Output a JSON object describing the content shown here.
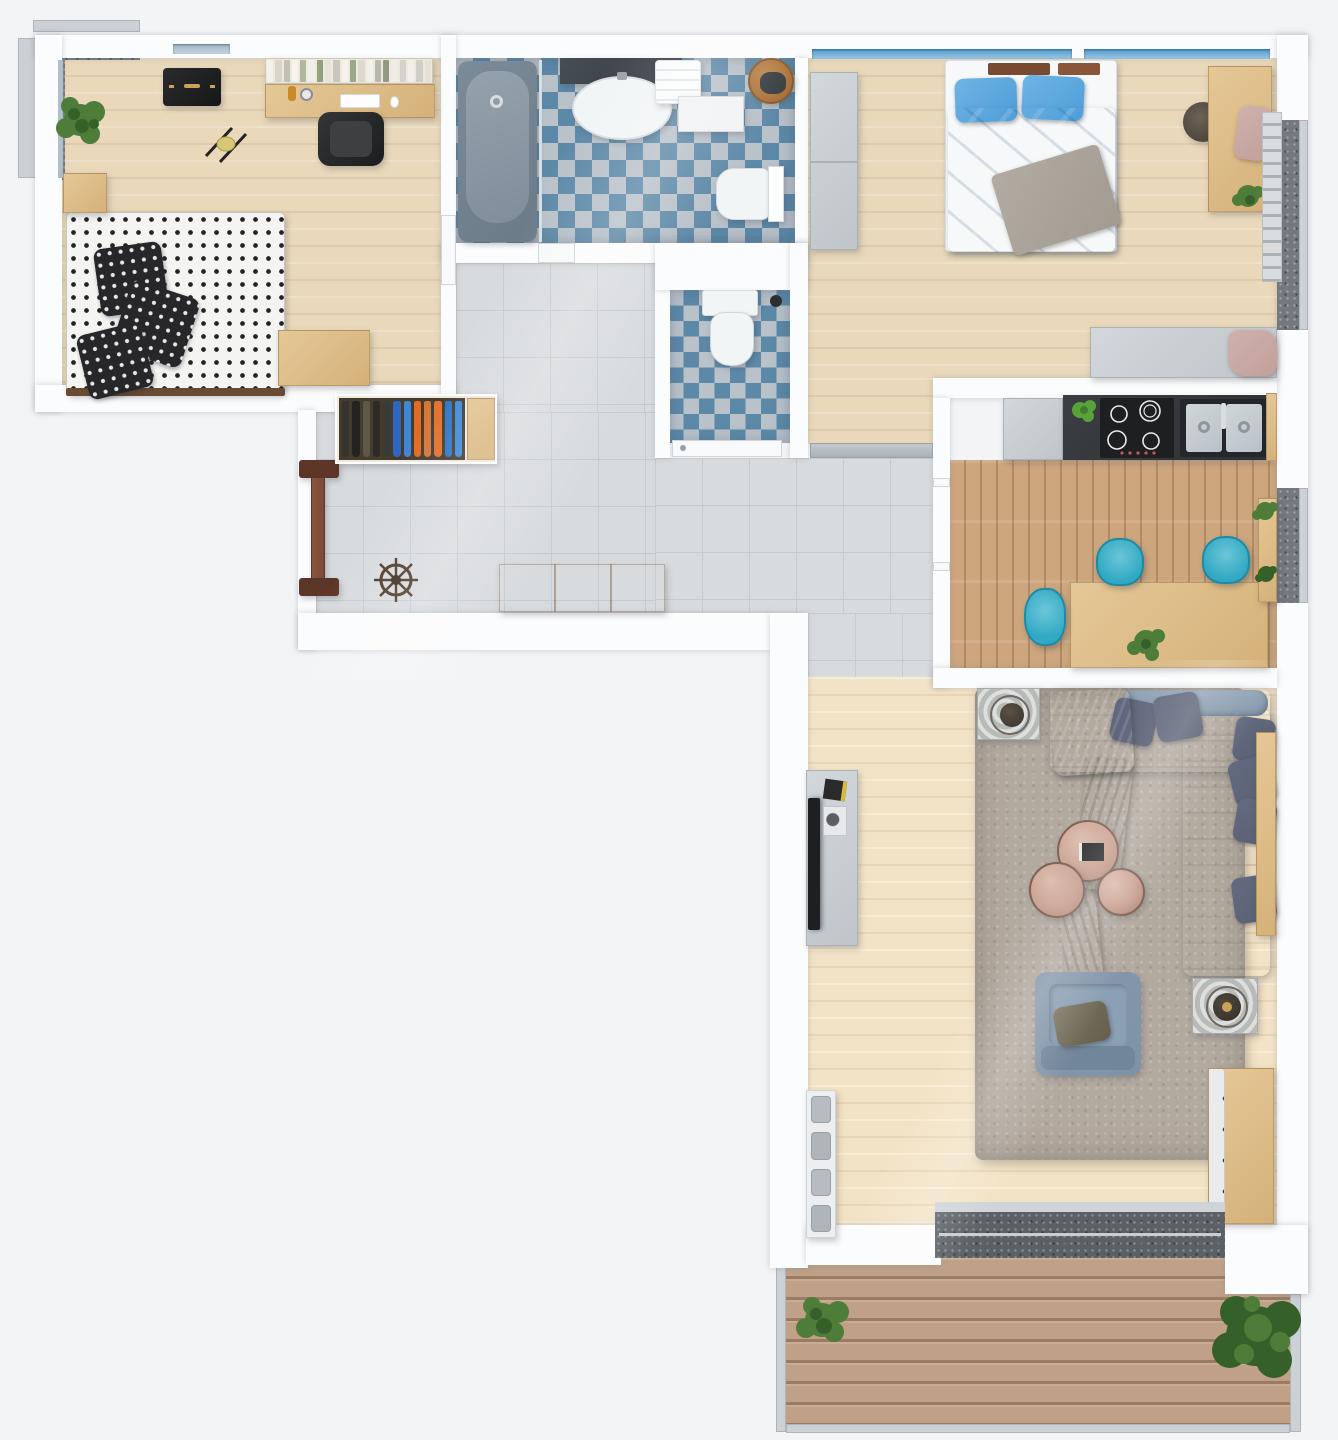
{
  "scene": {
    "type": "apartment-floor-plan-3d-top-view",
    "rooms": [
      "kids-bedroom",
      "bathroom",
      "wc",
      "master-bedroom",
      "kitchen-dining",
      "hallway",
      "living-room",
      "balcony-terrace",
      "french-balcony-top-left",
      "french-balcony-bedroom",
      "french-balcony-kitchen"
    ]
  },
  "palette": {
    "outside": "#f3f4f6",
    "wall": "#fbfcfd",
    "wood": "#e9d8ba",
    "wood_f": "#e5c897",
    "wood_f2": "#d5b179",
    "kitchen_wood": "#cda67e",
    "tile": "#d8dbde",
    "tile_line": "#c7cbcf",
    "checker_blue": "#5d89a8",
    "checker_gray": "#b9c1c9",
    "granite": "#73797e",
    "railing": "#ccd1d6",
    "window_blue": "#4f9cd0",
    "deck": "#c0a187",
    "deck_line": "#9a7c62",
    "sofa": "#7e92a6",
    "cushion": "#585f72",
    "rug": "#b2a99f",
    "marble": "#c9a191",
    "marble_dark": "#7d5f53",
    "olive": "#6e6c52",
    "bed_blue": "#4e9ed8",
    "blanket": "#a19b91",
    "teal": "#31a9c4",
    "counter": "#2e3134",
    "steel": "#b9c2c8",
    "door": "#7b4a36",
    "door_dark": "#5d3628",
    "basket": "#a86f3a",
    "tv": "#1d1f21",
    "plant": "#4e7d3a",
    "plant_dark": "#35602a",
    "dot_dark": "#232323",
    "pink": "#c2a09c",
    "tub_outer": "#6b7a87",
    "tub_inner": "#93a2ad",
    "white_fix": "#f2f5f6"
  },
  "kids_room": {
    "items": [
      "single-bed-polka-dot",
      "pillows",
      "nightstand",
      "desk",
      "bookshelf",
      "office-chair",
      "black-chest",
      "rocking-toy",
      "bench",
      "potted-plant"
    ],
    "book_colors": [
      "#f2f1ec",
      "#d8d6cc",
      "#c2c0b6",
      "#f5f4ef",
      "#aeb8a0",
      "#efeee8",
      "#8ea27c",
      "#e6e4da",
      "#c9c7bd",
      "#f4f3ee",
      "#9aa88a",
      "#dcdad0",
      "#f1f0ea",
      "#b9b8ae",
      "#8f9c80",
      "#eeede7",
      "#d4d2c8",
      "#f0efe9",
      "#cfcec6",
      "#e3e1d8"
    ]
  },
  "bathroom": {
    "items": [
      "bathtub",
      "vanity-sink",
      "towels",
      "cabinet",
      "laundry-basket",
      "toilet"
    ]
  },
  "wc": {
    "items": [
      "toilet"
    ]
  },
  "bedroom": {
    "items": [
      "double-bed-blue",
      "wardrobe",
      "desk",
      "pouf",
      "dresser",
      "towel-rack",
      "plant"
    ]
  },
  "kitchen": {
    "items": [
      "cooktop",
      "double-sink",
      "counter",
      "white-cabinet",
      "dining-table",
      "teal-chairs-x3",
      "herb-plant",
      "plant-shelf"
    ]
  },
  "hallway": {
    "items": [
      "open-wardrobe",
      "entrance-door",
      "ship-wheel-decor",
      "shoe-bench"
    ],
    "wardrobe_clothes_colors": [
      "#35342f",
      "#23231f",
      "#5c5948",
      "#2c2b28",
      "#3a3a36",
      "#2e67c0",
      "#3f86d6",
      "#e06a26",
      "#d3773b",
      "#e2702c",
      "#2f74c8",
      "#3f8ad8"
    ]
  },
  "living_room": {
    "items": [
      "corner-sofa",
      "throw-blanket",
      "cushions",
      "coffee-table-set-x3",
      "armchair",
      "side-table-x2",
      "tv-stand",
      "tv",
      "sideboard",
      "dresser",
      "shelf-with-seat-pads",
      "shag-rug",
      "sliding-door"
    ]
  },
  "balcony": {
    "items": [
      "wood-decking",
      "bush-left",
      "bush-right",
      "glass-railing"
    ]
  }
}
